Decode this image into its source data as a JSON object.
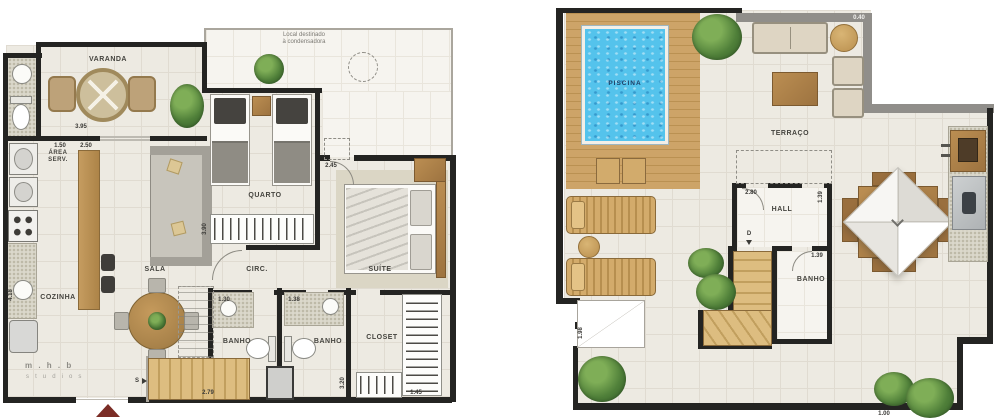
{
  "canvas": {
    "width": 1000,
    "height": 419,
    "background": "#ffffff"
  },
  "colors": {
    "wall": "#242422",
    "wall_gray": "#908e8a",
    "floor_tile": "#edeae2",
    "wood_deck": "#cda468",
    "pool_water": "#54c3ec",
    "plant_green": "#4f7f39",
    "entry_marker_red": "#7b2d26",
    "label_text": "#45443f"
  },
  "lower_plan": {
    "rooms": {
      "varanda": "VARANDA",
      "area_serv": "ÁREA SERV.",
      "cozinha": "COZINHA",
      "sala": "SALA",
      "quarto": "QUARTO",
      "circ": "CIRC.",
      "suite": "SUÍTE",
      "banho_1": "BANHO",
      "banho_2": "BANHO",
      "closet": "CLOSET"
    },
    "stair_label": "S",
    "condenser_note_line1": "Local destinado",
    "condenser_note_line2": "à condensadora",
    "watermark_line1": "m . h . b",
    "watermark_line2": "s t u d i o s",
    "dims": {
      "d1": "3.95",
      "d2": "1.50",
      "d3": "2.50",
      "d4": "2.45",
      "d5": "3.90",
      "d6": "1.30",
      "d7": "1.38",
      "d8": "2.79",
      "d9": "1.45",
      "d10": "4.18",
      "d11": "3.20"
    }
  },
  "upper_plan": {
    "rooms": {
      "piscina": "PISCINA",
      "terraco": "TERRAÇO",
      "hall": "HALL",
      "banho": "BANHO"
    },
    "stair_label": "D",
    "dims": {
      "d1": "0.40",
      "d2": "2.80",
      "d3": "1.39",
      "d4": "1.39",
      "d5": "1.00",
      "d6": "1.98"
    }
  }
}
